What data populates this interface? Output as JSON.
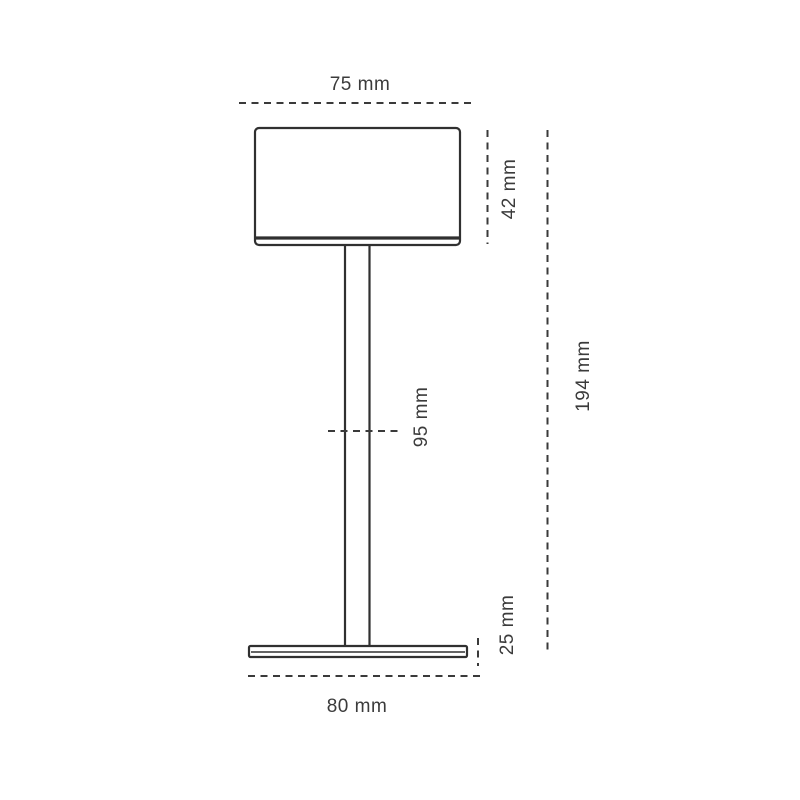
{
  "drawing": {
    "units": "mm",
    "colors": {
      "line": "#303030",
      "dim_line": "#3a3a3a",
      "text": "#3b3b3b",
      "background": "#ffffff"
    },
    "dimensions": {
      "shade_width": "75 mm",
      "shade_height": "42 mm",
      "total_height": "194 mm",
      "stem_height": "95 mm",
      "base_height": "25 mm",
      "base_width": "80 mm"
    }
  }
}
